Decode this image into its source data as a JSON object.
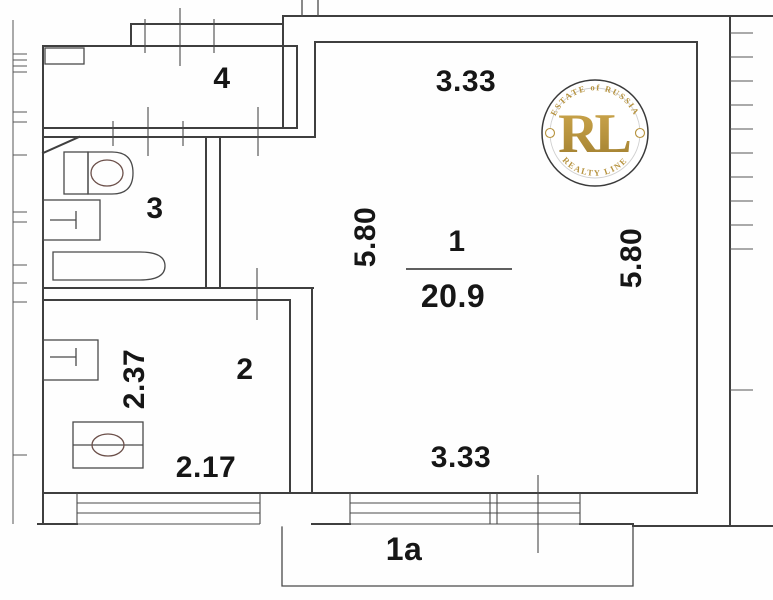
{
  "colors": {
    "background": "#fefefe",
    "wall_line": "#3f3f3f",
    "fixture_curve": "#6b4f49",
    "label_text": "#161616",
    "logo_gold": "#b6923d",
    "logo_ring": "#3a3a3a"
  },
  "rooms": {
    "living": {
      "number": "1",
      "area": "20.9"
    },
    "kitchen": {
      "number": "2"
    },
    "bathroom": {
      "number": "3"
    },
    "hall": {
      "number": "4"
    },
    "balcony": {
      "number": "1a"
    }
  },
  "dimensions": {
    "top_width": "3.33",
    "bottom_width": "3.33",
    "left_height": "5.80",
    "right_height": "5.80",
    "kitchen_height": "2.37",
    "kitchen_width": "2.17"
  },
  "logo": {
    "arc_top": "ESTATE of RUSSIA",
    "monogram": "RL",
    "arc_bottom": "REALTY LINE"
  }
}
